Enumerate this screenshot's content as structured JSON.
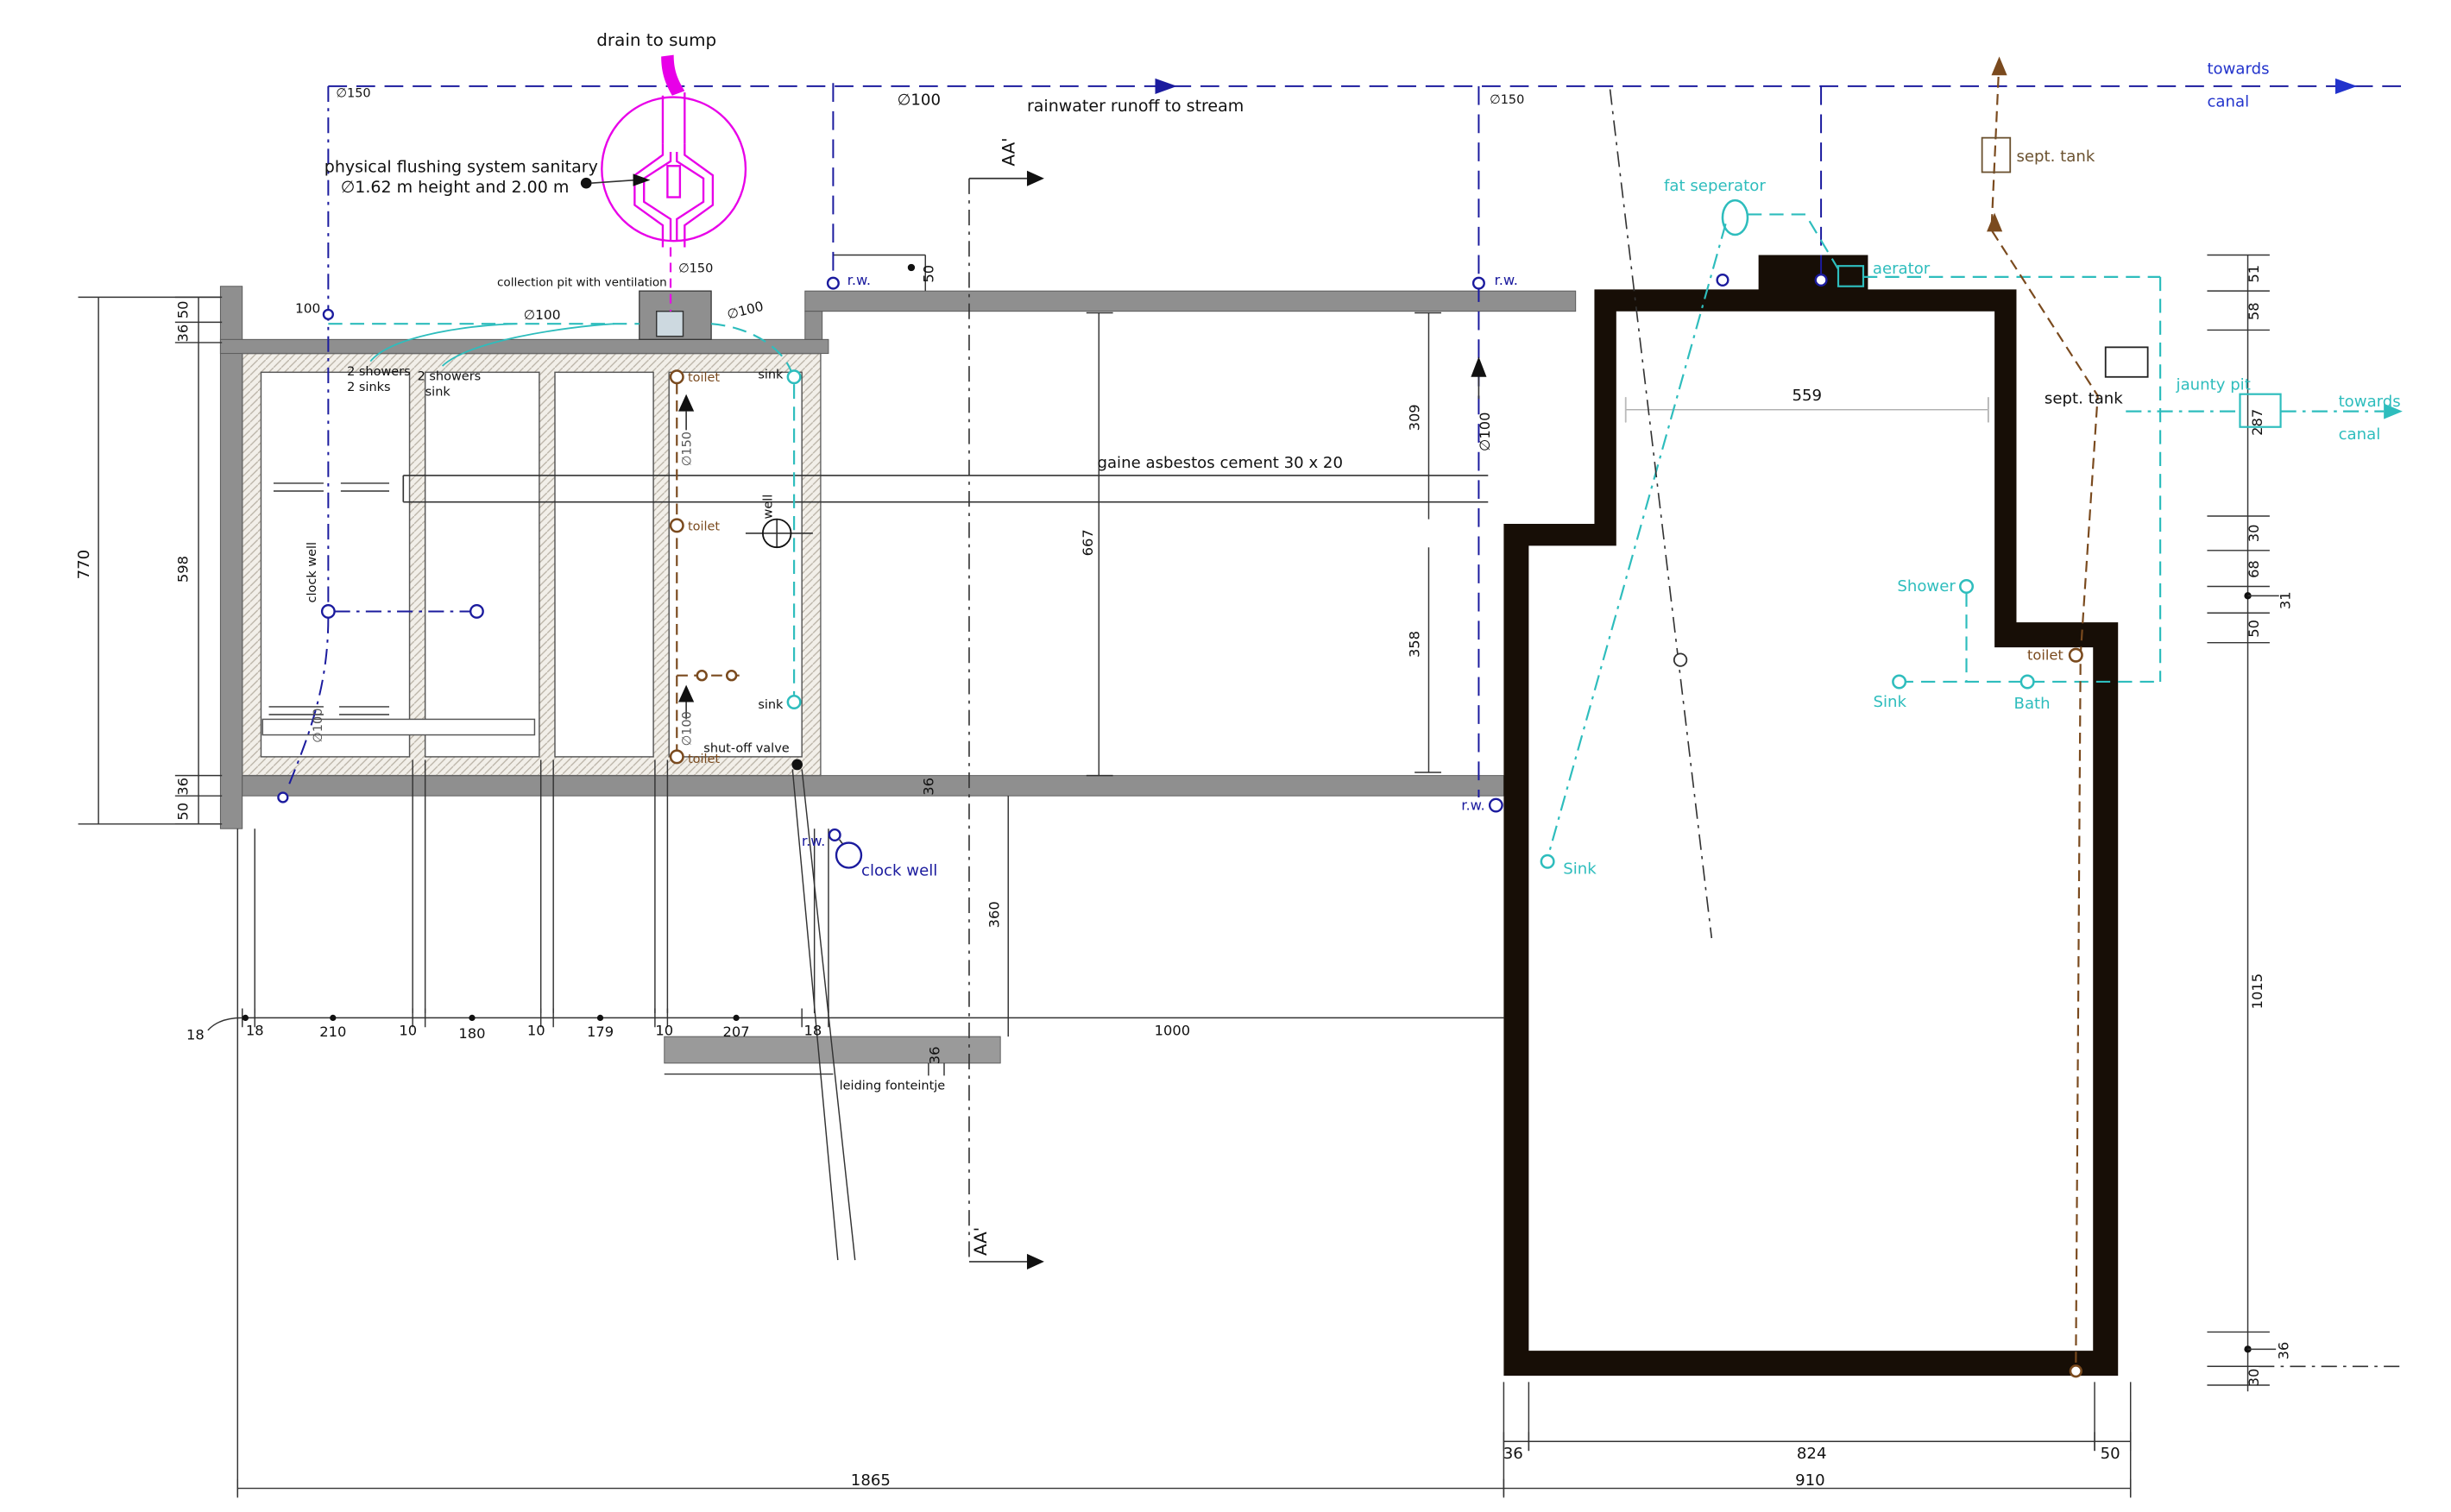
{
  "title": "sewage and sanitary ground plan",
  "colors": {
    "navy_pipe": "#1b1b9e",
    "canal_blue": "#2233cc",
    "sanitary_cyan": "#2ebdbd",
    "soil_brown": "#7a4a1e",
    "flushing_magenta": "#e800e8",
    "wall_gray": "#8f8f8f",
    "wall_dark": "#170e06"
  },
  "top": {
    "drain_to_sump": "drain to sump",
    "flushing_line1": "physical flushing system sanitary",
    "flushing_line2": "∅1.62 m height and 2.00 m",
    "dia150_left": "∅150",
    "dia100_rain": "∅100",
    "rainwater": "rainwater runoff to stream",
    "dia150_right": "∅150",
    "section_label": "AA'",
    "collection_pit": "collection pit with ventilation",
    "dia100_left": "∅100",
    "dia150_pit": "∅150",
    "dia100_right": "∅100",
    "rw_left": "r.w.",
    "dim_50": "50",
    "rw_right": "r.w.",
    "towards": "towards",
    "canal": "canal",
    "sept_tank": "sept. tank"
  },
  "left_building": {
    "dim_100": "100",
    "room1_line1": "2 showers",
    "room1_line2": "2 sinks",
    "room2_line1": "2 showers",
    "room2_line2": "sink",
    "clock_well": "clock well",
    "toilet_top": "toilet",
    "toilet_mid": "toilet",
    "toilet_bottom": "toilet",
    "sink_top": "sink",
    "sink_bottom": "sink",
    "dia150_riser": "∅150",
    "dia100_riser": "∅100",
    "well": "well",
    "shut_off_valve": "shut-off valve",
    "dia100_exit": "∅100"
  },
  "middle": {
    "gaine": "gaine asbestos cement 30 x 20",
    "dim_309": "309",
    "dim_667": "667",
    "dim_358": "358",
    "dim_559": "559",
    "dia100_down": "∅100",
    "dim_36_wall": "36",
    "dim_360": "360",
    "rw_out": "r.w.",
    "rw_cw": "r.w.",
    "clock_well": "clock well",
    "section_label": "AA'",
    "leiding": "leiding fonteintje",
    "dim_36_bar": "36"
  },
  "right_area": {
    "fat_seperator": "fat seperator",
    "aerator": "aerator",
    "sept_tank": "sept. tank",
    "jaunty_pit": "jaunty pit",
    "dim_287": "287",
    "towards": "towards",
    "canal": "canal",
    "shower": "Shower",
    "toilet": "toilet",
    "sink": "Sink",
    "bath": "Bath",
    "sink2": "Sink"
  },
  "dims_left": {
    "d770": "770",
    "d50_top": "50",
    "d36_top": "36",
    "d598": "598",
    "d36_bottom": "36",
    "d50_bottom": "50"
  },
  "dims_bottom": {
    "d18_out": "18",
    "d18_left": "18",
    "d210": "210",
    "d10_a": "10",
    "d180": "180",
    "d10_b": "10",
    "d179": "179",
    "d10_c": "10",
    "d207": "207",
    "d18_right": "18",
    "d1000": "1000",
    "d1865": "1865",
    "d36": "36",
    "d824": "824",
    "d50": "50",
    "d910": "910"
  },
  "dims_right": {
    "d51": "51",
    "d58": "58",
    "d30_top": "30",
    "d68": "68",
    "d31": "31",
    "d50": "50",
    "d1015": "1015",
    "d36": "36",
    "d30_bottom": "30"
  }
}
